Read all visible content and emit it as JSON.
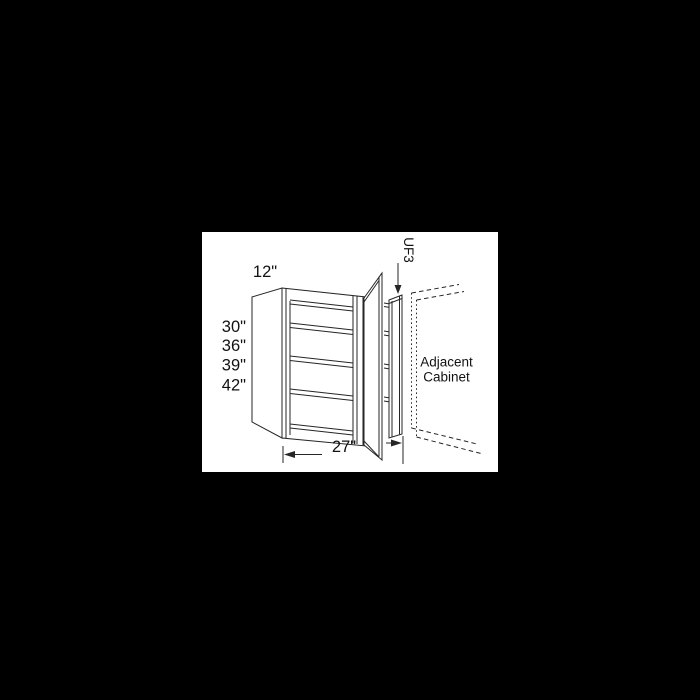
{
  "colors": {
    "page": "#000000",
    "canvas": "#ffffff",
    "line": "#262626",
    "text": "#121212"
  },
  "diagram": {
    "kind": "blind-corner-wall-cabinet-spec-drawing",
    "depth_label": "12\"",
    "height_options": [
      "30\"",
      "36\"",
      "39\"",
      "42\""
    ],
    "width_label": "27\"",
    "filler_label": "UF3",
    "adjacent_label_line1": "Adjacent",
    "adjacent_label_line2": "Cabinet"
  }
}
